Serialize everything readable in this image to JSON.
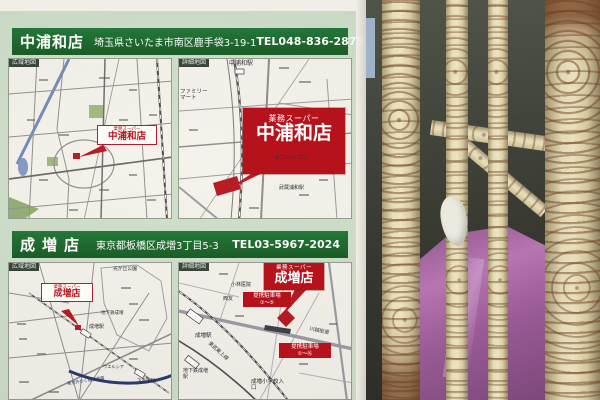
{
  "poster": {
    "sections": [
      {
        "store_name": "中浦和店",
        "address": "埼玉県さいたま市南区鹿手袋3-19-1",
        "tel": "TEL048-836-2875",
        "wide_map": {
          "corner_tag": "広域地図",
          "brand": "業務スーパー",
          "name": "中浦和店"
        },
        "detail_map": {
          "corner_tag": "詳細地図",
          "brand": "業務スーパー",
          "name": "中浦和店",
          "labels": [
            "中浦和駅",
            "ファミリーマート",
            "セブンイレブン",
            "武蔵浦和駅"
          ]
        }
      },
      {
        "store_name": "成増店",
        "address": "東京都板橋区成増3丁目5-3",
        "tel": "TEL03-5967-2024",
        "wide_map": {
          "corner_tag": "広域地図",
          "brand": "業務スーパー",
          "name": "成増店",
          "labels": [
            "光が丘公園",
            "地下鉄成増",
            "成増駅",
            "ウエルシア",
            "下赤塚駅",
            "東京外かく環状道路"
          ]
        },
        "detail_map": {
          "corner_tag": "詳細地図",
          "brand": "業務スーパー",
          "name": "成増店",
          "labels": [
            "小林医院",
            "西友",
            "成増駅",
            "地下鉄成増駅",
            "東武東上線",
            "川越街道",
            "成増小学校入口"
          ],
          "parking": [
            {
              "title": "提携駐車場",
              "range": "①〜⑤"
            },
            {
              "title": "提携駐車場",
              "range": "①〜⑯"
            }
          ]
        }
      }
    ]
  },
  "colors": {
    "banner_green": "#166a2d",
    "panel_green": "#cddfca",
    "accent_red": "#b5121c",
    "map_navy": "#23356b",
    "fence_cream": "#ddd2a8",
    "tarp_purple": "#a565a0"
  }
}
